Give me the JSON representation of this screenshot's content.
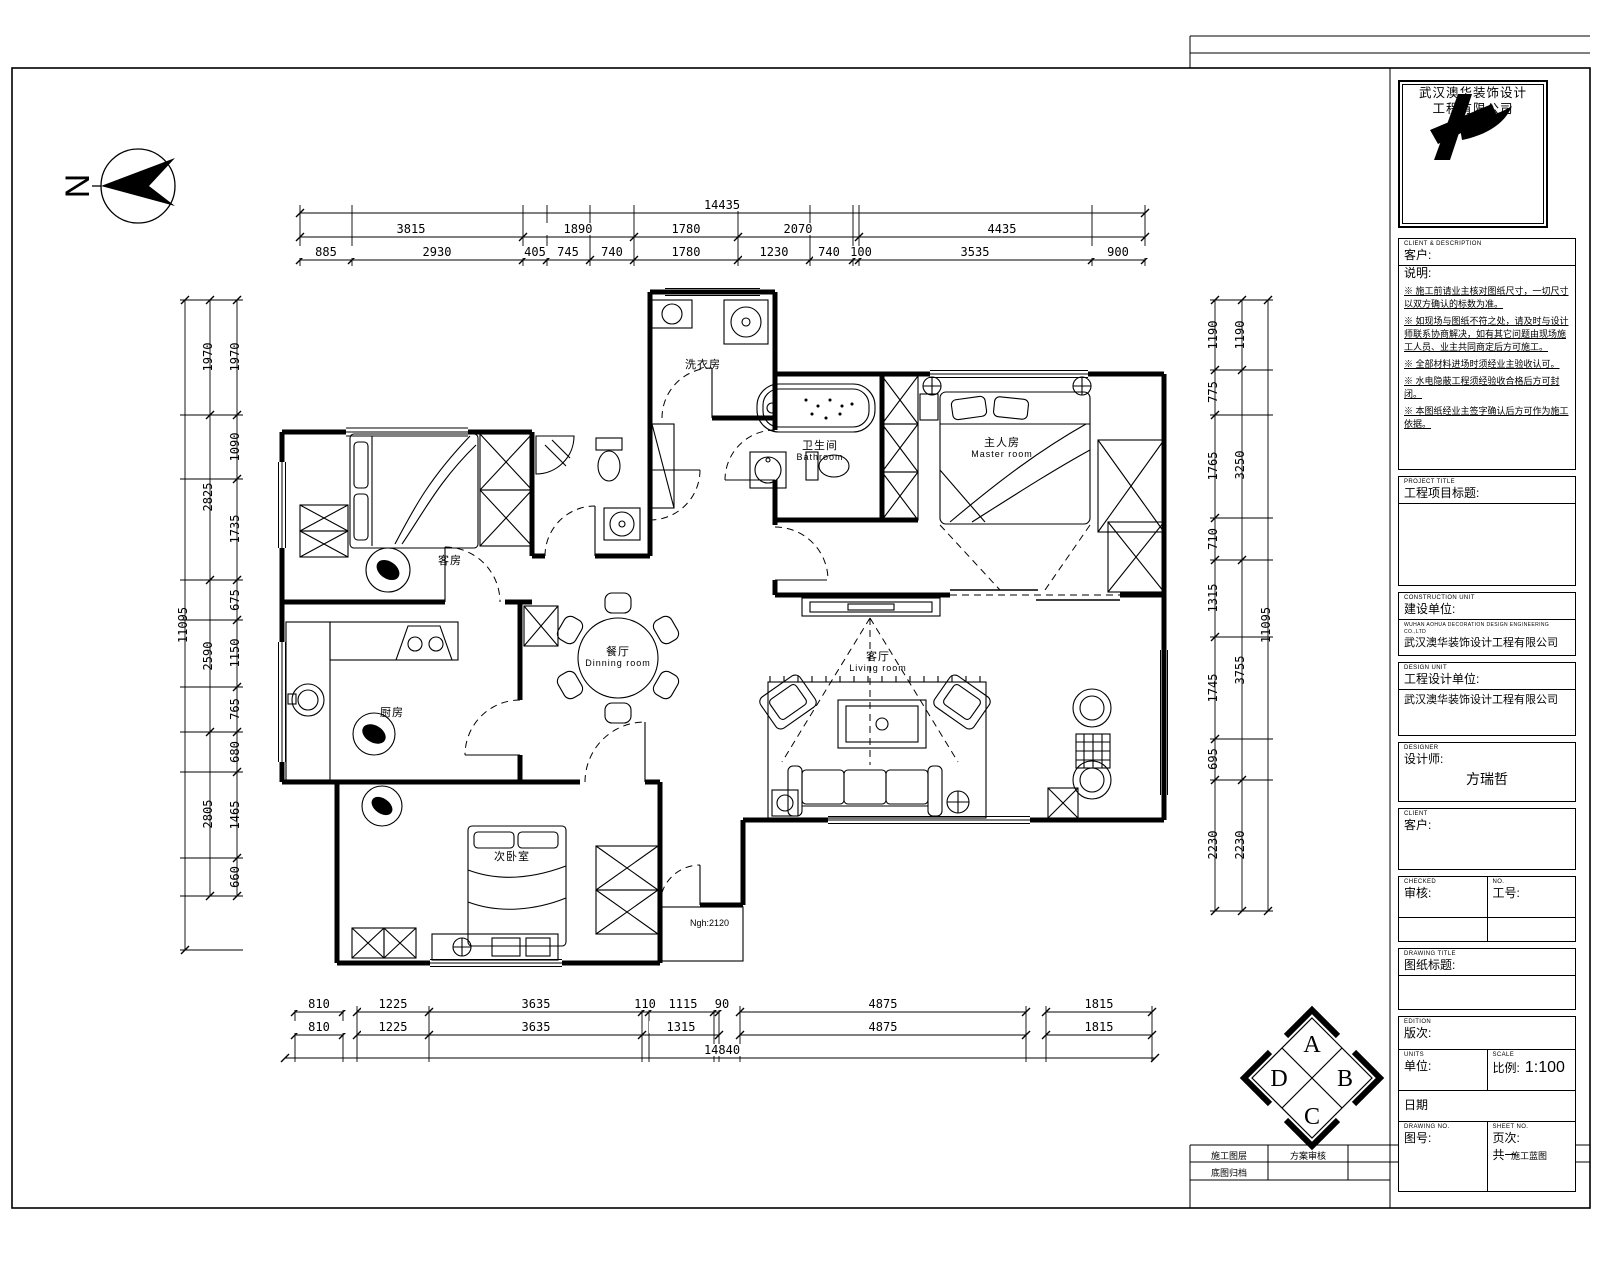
{
  "north_letter": "N",
  "dims": {
    "top1": [
      "14435"
    ],
    "top2": [
      "3815",
      "1890",
      "1780",
      "2070",
      "4435"
    ],
    "top3": [
      "885",
      "2930",
      "405",
      "745",
      "740",
      "1780",
      "1230",
      "740",
      "100",
      "3535",
      "900"
    ],
    "left_outer": [
      "11095"
    ],
    "left_mid": [
      "1970",
      "2825",
      "2590",
      "2805"
    ],
    "left_inner": [
      "1970",
      "1090",
      "1735",
      "675",
      "1150",
      "765",
      "680",
      "1465",
      "660"
    ],
    "right_inner": [
      "1190",
      "775",
      "1765",
      "710",
      "1315",
      "1745",
      "695",
      "2230"
    ],
    "right_mid": [
      "1190",
      "3250",
      "3755",
      "2230"
    ],
    "right_outer": [
      "11095"
    ],
    "bottom1": [
      "810",
      "1225",
      "3635",
      "110",
      "1115",
      "90",
      "4875",
      "1815"
    ],
    "bottom2": [
      "810",
      "1225",
      "3635",
      "1315",
      "4875",
      "1815"
    ],
    "bottom3": [
      "14840"
    ]
  },
  "rooms": {
    "laundry": {
      "cn": "洗衣房"
    },
    "guest": {
      "cn": "客房"
    },
    "bath": {
      "cn": "卫生间",
      "en": "Bathroom"
    },
    "master": {
      "cn": "主人房",
      "en": "Master room"
    },
    "dining": {
      "cn": "餐厅",
      "en": "Dinning room"
    },
    "living": {
      "cn": "客厅",
      "en": "Living room"
    },
    "kitchen": {
      "cn": "厨房"
    },
    "bedroom2": {
      "cn": "次卧室"
    },
    "door_note": "Ngh:2120"
  },
  "elevation_marker": {
    "a": "A",
    "b": "B",
    "c": "C",
    "d": "D"
  },
  "title_block": {
    "logo_line1": "武汉澳华装饰设计",
    "logo_line2": "工程有限公司",
    "client_tiny": "CLIENT & DESCRIPTION",
    "client_label": "客户:",
    "desc_label": "说明:",
    "notes": [
      "※ 施工前请业主核对图纸尺寸，一切尺寸以双方确认的标数为准。",
      "※ 如现场与图纸不符之处，请及时与设计师联系协商解决，如有其它问题由现场施工人员、业主共同商定后方可施工。",
      "※ 全部材料进场时须经业主验收认可。",
      "※ 水电隐蔽工程须经验收合格后方可封闭。",
      "※ 本图纸经业主签字确认后方可作为施工依据。"
    ],
    "project_tiny": "PROJECT TITLE",
    "project_label": "工程项目标题:",
    "owner_tiny": "CONSTRUCTION UNIT",
    "owner_label": "建设单位:",
    "owner_value_tiny": "WUHAN AOHUA DECORATION DESIGN ENGINEERING CO.,LTD",
    "owner_value": "武汉澳华装饰设计工程有限公司",
    "design_tiny": "DESIGN UNIT",
    "design_label": "工程设计单位:",
    "design_value": "武汉澳华装饰设计工程有限公司",
    "designer_tiny": "DESIGNER",
    "designer_label": "设计师:",
    "designer_value": "方瑞哲",
    "sign_tiny": "CLIENT",
    "sign_label": "客户:",
    "check_tiny": "CHECKED",
    "check_label": "审核:",
    "jobno_tiny": "NO.",
    "jobno_label": "工号:",
    "dwgtitle_tiny": "DRAWING TITLE",
    "dwgtitle_label": "图纸标题:",
    "edition_tiny": "EDITION",
    "edition_label": "版次:",
    "units_tiny": "UNITS",
    "units_label": "单位:",
    "scale_tiny": "SCALE",
    "scale_label": "比例:",
    "scale_value": "1:100",
    "date_label": "日期",
    "dwgno_tiny": "DRAWING NO.",
    "dwgno_label": "图号:",
    "sheet_tiny": "SHEET NO.",
    "sheet_label": "页次:",
    "sheet_value": "共一",
    "strip_c1": "施工图层",
    "strip_c2": "方案审核",
    "strip_c3": "施工蓝图",
    "strip_c4": "底图归档"
  }
}
